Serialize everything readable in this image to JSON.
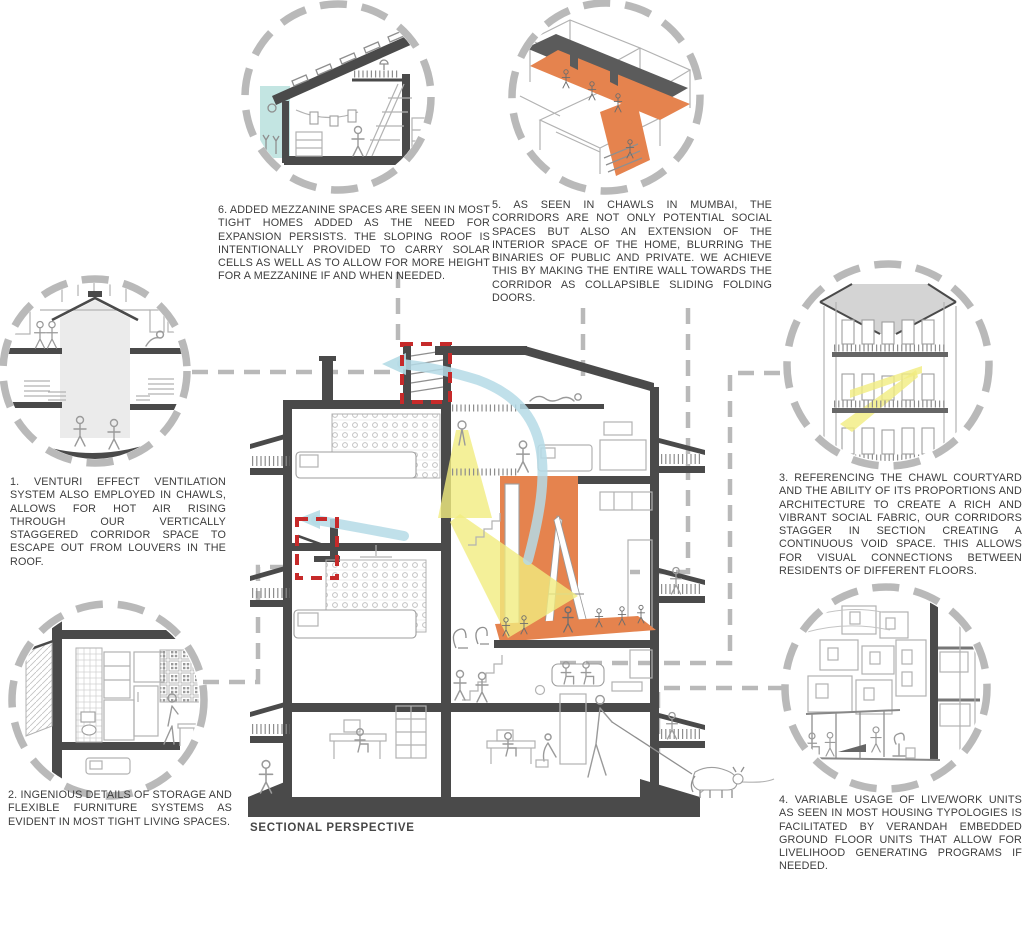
{
  "drawing": {
    "label": "SECTIONAL PERSPECTIVE"
  },
  "callouts": [
    {
      "id": "1",
      "text": "1. VENTURI EFFECT VENTILATION SYSTEM ALSO EMPLOYED IN CHAWLS, ALLOWS FOR HOT AIR RISING THROUGH OUR VERTICALLY STAGGERED CORRIDOR SPACE TO ESCAPE OUT FROM LOUVERS IN THE ROOF."
    },
    {
      "id": "2",
      "text": "2. INGENIOUS DETAILS OF STORAGE AND FLEXIBLE FURNITURE SYSTEMS AS EVIDENT IN MOST TIGHT LIVING SPACES."
    },
    {
      "id": "3",
      "text": "3. REFERENCING THE CHAWL COURTYARD AND THE ABILITY OF ITS PROPORTIONS AND ARCHITECTURE TO CREATE A RICH AND VIBRANT SOCIAL FABRIC, OUR CORRIDORS STAGGER IN SECTION CREATING A CONTINUOUS VOID SPACE. THIS ALLOWS FOR VISUAL CONNECTIONS BETWEEN RESIDENTS OF DIFFERENT FLOORS."
    },
    {
      "id": "4",
      "text": "4. VARIABLE USAGE OF LIVE/WORK UNITS AS SEEN IN MOST HOUSING TYPOLOGIES IS FACILITATED BY VERANDAH EMBEDDED GROUND FLOOR UNITS THAT ALLOW FOR LIVELIHOOD GENERATING PROGRAMS IF NEEDED."
    },
    {
      "id": "5",
      "text": "5. AS SEEN IN CHAWLS IN MUMBAI, THE CORRIDORS ARE NOT ONLY POTENTIAL SOCIAL SPACES BUT ALSO AN EXTENSION OF THE INTERIOR SPACE OF THE HOME, BLURRING THE BINARIES OF PUBLIC AND PRIVATE. WE ACHIEVE THIS BY MAKING THE ENTIRE WALL TOWARDS THE CORRIDOR AS COLLAPSIBLE SLIDING FOLDING DOORS."
    },
    {
      "id": "6",
      "text": "6. ADDED MEZZANINE SPACES ARE SEEN IN MOST TIGHT HOMES ADDED AS THE NEED FOR EXPANSION PERSISTS. THE SLOPING ROOF IS INTENTIONALLY PROVIDED TO CARRY SOLAR CELLS AS WELL AS TO ALLOW FOR MORE HEIGHT FOR A MEZZANINE IF AND WHEN NEEDED."
    }
  ],
  "colors": {
    "corridor_orange": "#E5834E",
    "light_beam_yellow": "#F1EC7F",
    "airflow_blue": "#B5DBE6",
    "highlight_red": "#C62A2A",
    "dashed_gray": "#B9B9B9",
    "structure_dark": "#4A4A4A",
    "sky_teal": "#C3E5E2"
  }
}
